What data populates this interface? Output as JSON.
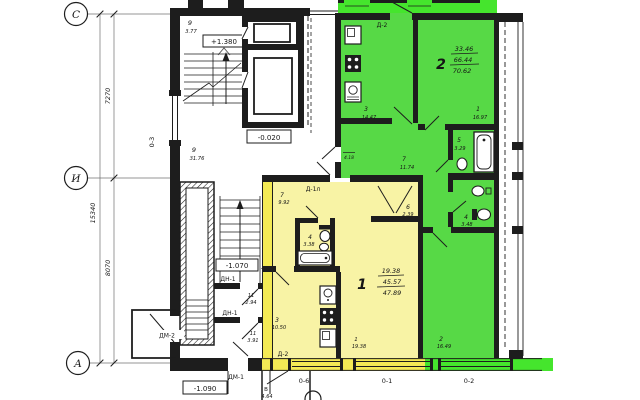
{
  "colors": {
    "wall": "#1d1d1d",
    "green": "#57d946",
    "green_bright": "#45e52d",
    "yellow": "#f8f3a5",
    "yellow_bright": "#f3ea55",
    "grid_line": "#707070"
  },
  "grid": {
    "row_c": "С",
    "row_i": "И",
    "row_a": "А",
    "dim_total": "15340",
    "dim_upper": "7270",
    "dim_lower": "8070"
  },
  "levels": {
    "upper_landing": "+1.380",
    "entry_landing": "-0.020",
    "lower_landing": "-1.070",
    "exit": "-1.090"
  },
  "common": {
    "stair_num": "9",
    "stair_area": "3.77",
    "corridor_num": "9",
    "corridor_area": "31.76",
    "lobby_num": "9",
    "lobby_area": "4.07",
    "tambour1_num": "11",
    "tambour1_area": "2.94",
    "tambour2_num": "11",
    "tambour2_area": "3.91"
  },
  "windows": {
    "o3": "0-3",
    "o6": "0-6",
    "o1": "0-1",
    "o2": "0-2"
  },
  "doors": {
    "d2_top": "Д-2",
    "d1l": "Д-1л",
    "dn1_a": "ДН-1",
    "dn1_b": "ДН-1",
    "dm1": "ДМ-1",
    "dm2": "ДМ-2",
    "d2_bottom": "Д-2"
  },
  "apt2": {
    "number": "2",
    "area_living": "33.46",
    "area_total": "66.44",
    "area_overall": "70.62",
    "loggia_area": "4.18",
    "kitchen_num": "3",
    "kitchen_area": "14.47",
    "living_num": "1",
    "living_area": "16.97",
    "bath_num": "5",
    "bath_area": "3.29",
    "wc_num": "4",
    "wc_area": "3.48",
    "hall_num": "7",
    "hall_area": "11.74",
    "bed_num": "2",
    "bed_area": "16.49"
  },
  "apt1": {
    "number": "1",
    "area_living": "19.38",
    "area_total": "45.57",
    "area_overall": "47.89",
    "balcony_label": "В",
    "balcony_area": "4.64",
    "hall_num": "7",
    "hall_area": "9.92",
    "bath_num": "4",
    "bath_area": "3.38",
    "closet_num": "6",
    "closet_area": "2.39",
    "room_num": "1",
    "room_area": "19.38",
    "kitchen_num": "3",
    "kitchen_area": "10.50"
  }
}
